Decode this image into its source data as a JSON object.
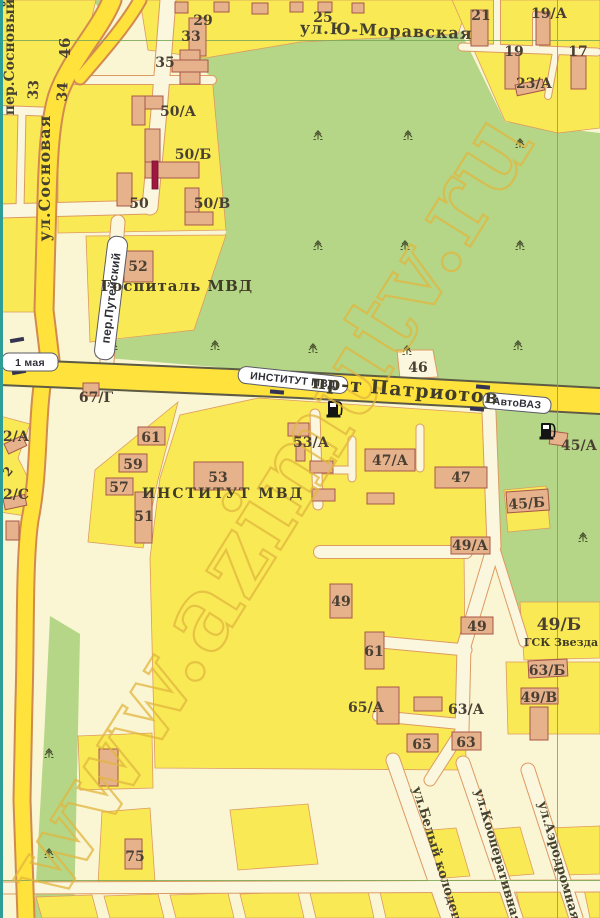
{
  "watermark": "www.azimutv.ru",
  "streets": {
    "sosnovy": "пер.Сосновый",
    "sosnovaya": "ул.Сосновая",
    "moravskaya": "ул.Ю-Моравская",
    "puteysky": "пер.Путейский",
    "patriotov": "пр-т Патриотов",
    "kolodets": "ул.Белый колодец",
    "kooperativnaya": "ул.Кооперативная",
    "aerodromnaya": "ул.Аэродромная",
    "side_33": "33",
    "side_34": "34",
    "side_46": "46"
  },
  "stops": {
    "may1": "1 мая",
    "institut": "ИНСТИТУТ МВД",
    "avtovaz": "АвтоВАЗ"
  },
  "places": {
    "hospital": "Госпиталь МВД",
    "institute": "ИНСТИТУТ МВД",
    "gsk": "ГСК Звезда"
  },
  "buildings": {
    "b29": "29",
    "b25": "25",
    "b21": "21",
    "b19a": "19/А",
    "b19": "19",
    "b17": "17",
    "b23a": "23/А",
    "b33": "33",
    "b35": "35",
    "b50a": "50/А",
    "b50b": "50/Б",
    "b50": "50",
    "b50v": "50/В",
    "b52": "52",
    "b46": "46",
    "b67g": "67/Г",
    "b2a": "2/А",
    "b2": "2",
    "b2s": "2/С",
    "b61": "61",
    "b59": "59",
    "b57": "57",
    "b51": "51",
    "b53": "53",
    "b53a": "53/А",
    "b47a": "47/А",
    "b47": "47",
    "b45a": "45/А",
    "b45b": "45/Б",
    "b49a": "49/А",
    "b49w": "49",
    "b49e": "49",
    "b61s": "61",
    "b49b": "49/Б",
    "b63b": "63/Б",
    "b49v": "49/В",
    "b65a": "65/А",
    "b63a": "63/А",
    "b65": "65",
    "b63": "63",
    "b75": "75"
  }
}
